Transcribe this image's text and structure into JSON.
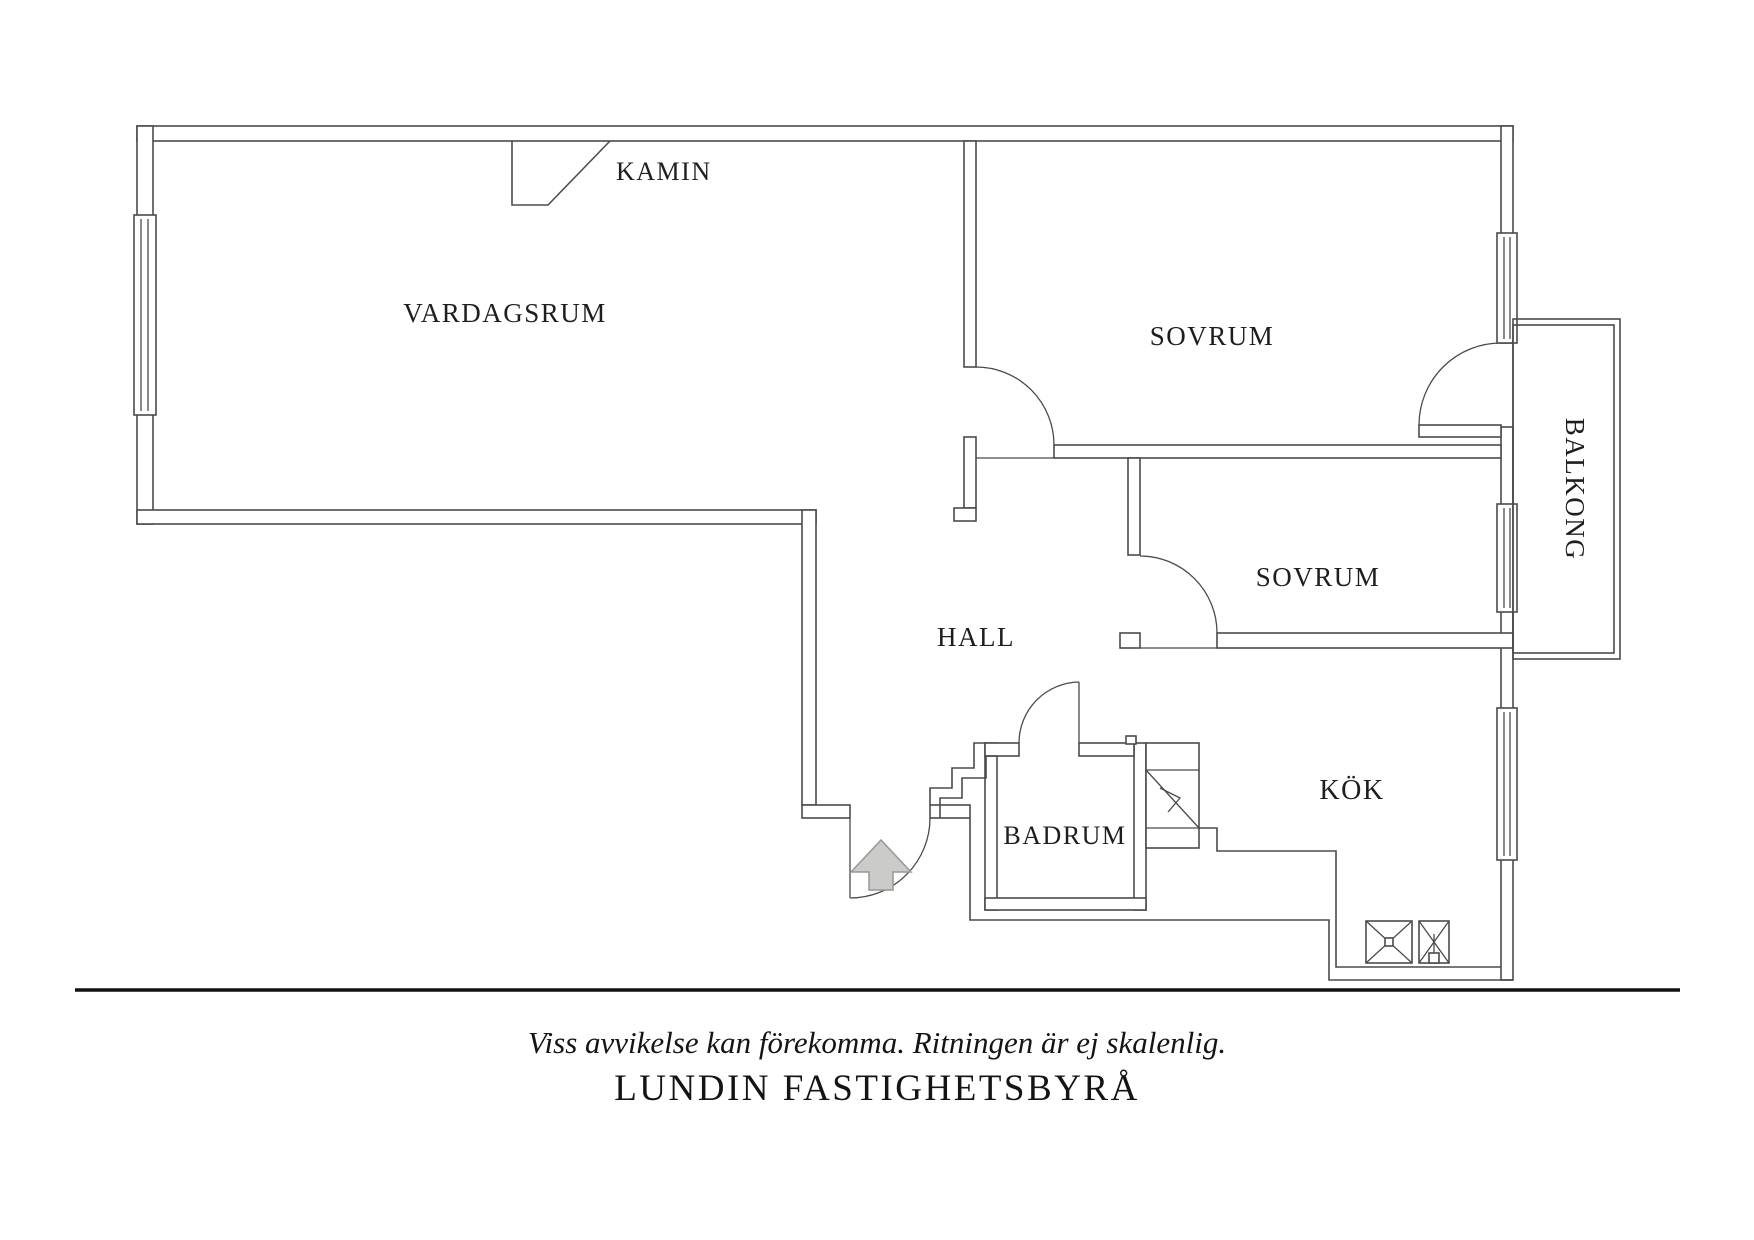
{
  "floor_plan": {
    "rooms": {
      "vardagsrum": "VARDAGSRUM",
      "kamin": "KAMIN",
      "sovrum_1": "SOVRUM",
      "sovrum_2": "SOVRUM",
      "hall": "HALL",
      "badrum": "BADRUM",
      "kok": "KÖK",
      "balkong": "BALKONG"
    },
    "icons": {
      "entry_arrow": "up-arrow-entrance",
      "stove": "stove-x-symbol",
      "sink": "sink-x-symbol",
      "shaft": "shaft-diagonal-symbol",
      "window": "triple-line-window-symbol",
      "door": "quarter-circle-door-swing"
    },
    "colors": {
      "line": "#4b4b4b",
      "label": "#1e1e1e",
      "arrow_fill": "#cbcbc8",
      "arrow_stroke": "#97979a",
      "background": "#ffffff",
      "divider": "#111111"
    }
  },
  "footer": {
    "disclaimer": "Viss avvikelse kan förekomma. Ritningen är ej skalenlig.",
    "brand": "LUNDIN FASTIGHETSBYRÅ"
  }
}
